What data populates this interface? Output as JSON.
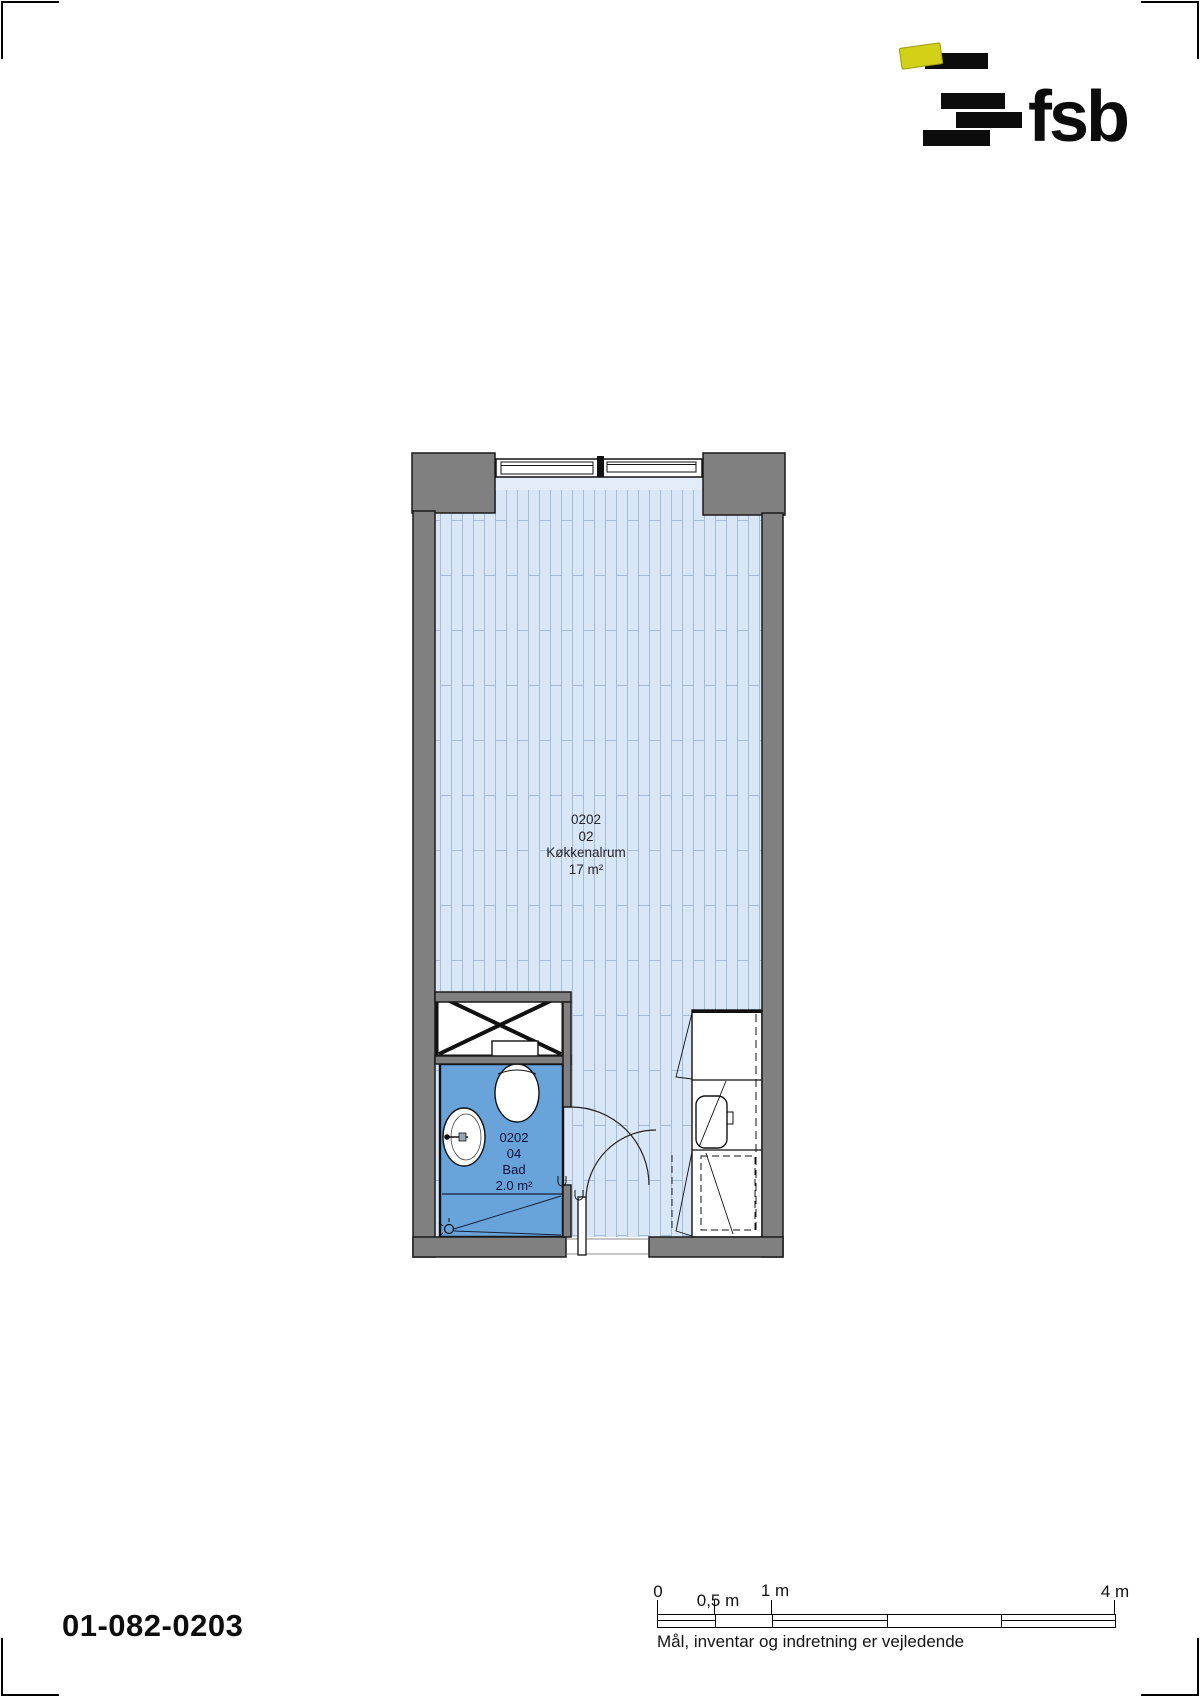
{
  "header": {
    "logo_text": "fsb"
  },
  "drawing": {
    "number": "01-082-0203",
    "disclaimer": "Mål, inventar og indretning er vejledende"
  },
  "rooms": {
    "main": {
      "number": "0202",
      "unit": "02",
      "name": "Køkkenalrum",
      "area": "17 m²"
    },
    "bath": {
      "number": "0202",
      "unit": "04",
      "name": "Bad",
      "area": "2.0 m²"
    }
  },
  "scale": {
    "t0": "0",
    "t05": "0,5 m",
    "t1": "1 m",
    "t4": "4 m"
  },
  "colors": {
    "wall_gray": "#808080",
    "floor_blue": "#d9e6f6",
    "floor_plank_line": "#a5bcd9",
    "bath_blue": "#68a3d9",
    "logo_yellow": "#d3d117",
    "ink": "#0c0c0c"
  }
}
